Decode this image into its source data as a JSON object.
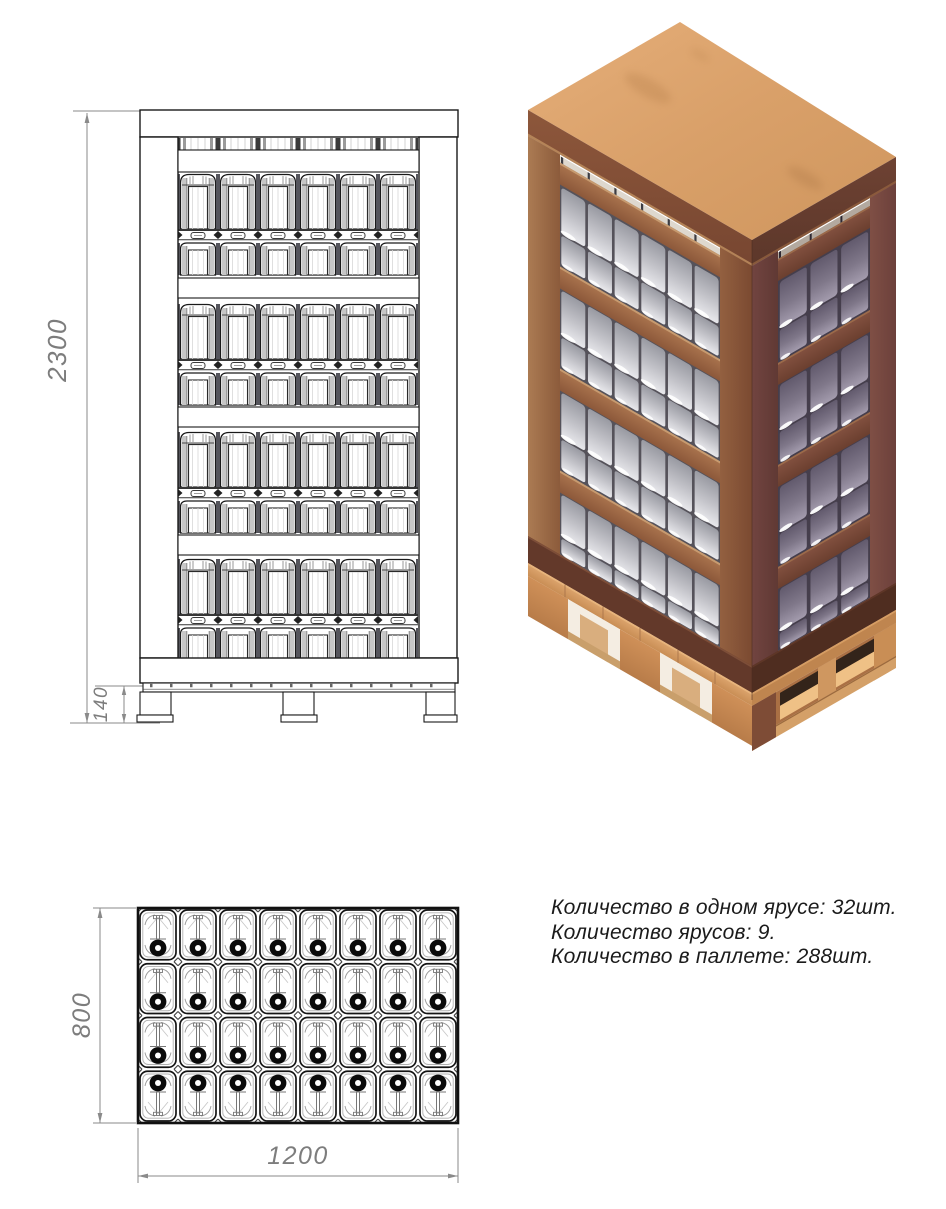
{
  "title": "Схема укладки на паллете 1200x800",
  "notes": {
    "line1": "Количество в одном ярусе: 32шт.",
    "line2": "Количество ярусов: 9.",
    "line3": "Количество в паллете: 288шт."
  },
  "packing": {
    "per_tier": 32,
    "tiers": 9,
    "total": 288
  },
  "dimensions": {
    "overall_height": "2300",
    "pallet_height": "140",
    "pallet_depth": "800",
    "pallet_width": "1200"
  },
  "front_view": {
    "canister_columns": 6,
    "tier_blocks": 4,
    "rails": 4
  },
  "top_view": {
    "columns": 8,
    "rows": 4,
    "cap_orientation_by_row": [
      "down",
      "down",
      "down",
      "up"
    ]
  },
  "iso_view": {
    "left_face_columns": 6,
    "right_face_columns": 3,
    "blocks": 4,
    "rails": 4
  },
  "colors": {
    "drawing_line": "#1a1a1a",
    "dimension": "#7d7d7d",
    "plywood_top": "#dca46f",
    "frame_light": "#a06a45",
    "frame_dark": "#6d4038",
    "canister_front": "#c2c2c8",
    "canister_side": "#837b8e",
    "pallet_wood": "#cf9058"
  }
}
